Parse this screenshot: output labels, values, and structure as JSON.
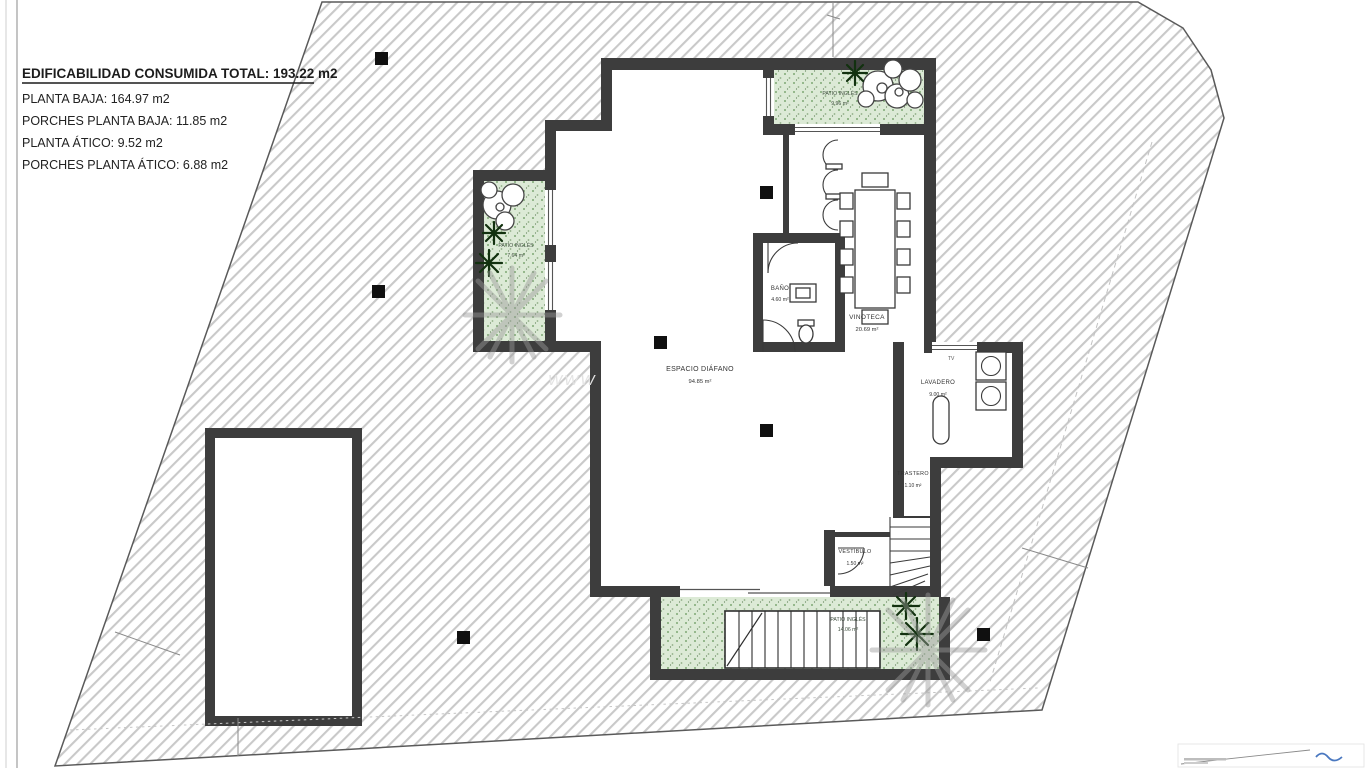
{
  "sheet": {
    "title_block": {
      "total": "EDIFICABILIDAD CONSUMIDA TOTAL: 193.22 m2",
      "rows": [
        "PLANTA BAJA: 164.97 m2",
        "PORCHES PLANTA BAJA: 11.85 m2",
        "PLANTA ÁTICO: 9.52 m2",
        "PORCHES PLANTA ÁTICO: 6.88 m2"
      ]
    },
    "watermark": "WWW"
  },
  "rooms": {
    "espacio_diafano": {
      "label": "ESPACIO DIÁFANO",
      "area": "94.85 m²"
    },
    "bano": {
      "label": "BAÑO",
      "area": "4.60 m²"
    },
    "vinoteca": {
      "label": "VINOTECA",
      "area": "20.69 m²"
    },
    "lavadero": {
      "label": "LAVADERO",
      "area": "9.00 m²"
    },
    "trastero": {
      "label": "TRASTERO",
      "area": "1.10 m²"
    },
    "vestibulo": {
      "label": "VESTÍBULO",
      "area": "1.50 m²"
    },
    "patio_ingles_top": {
      "label": "PATIO INGLÉS",
      "area": "9.96 m²"
    },
    "patio_ingles_left": {
      "label": "PATIO INGLÉS",
      "area": "7.64 m²"
    },
    "patio_ingles_bottom": {
      "label": "PATIO INGLÉS",
      "area": "14.06 m²"
    },
    "tv_label": "TV"
  },
  "colors": {
    "wall": "#3d3d3d",
    "hatch_line": "#c9c9c9",
    "patio_green": "#dcead6",
    "patio_dot_green": "#7fa874",
    "palm_dark_green": "#12310f",
    "shadow_gray": "#9a9a9a",
    "logo_blue": "#4a78c0"
  }
}
